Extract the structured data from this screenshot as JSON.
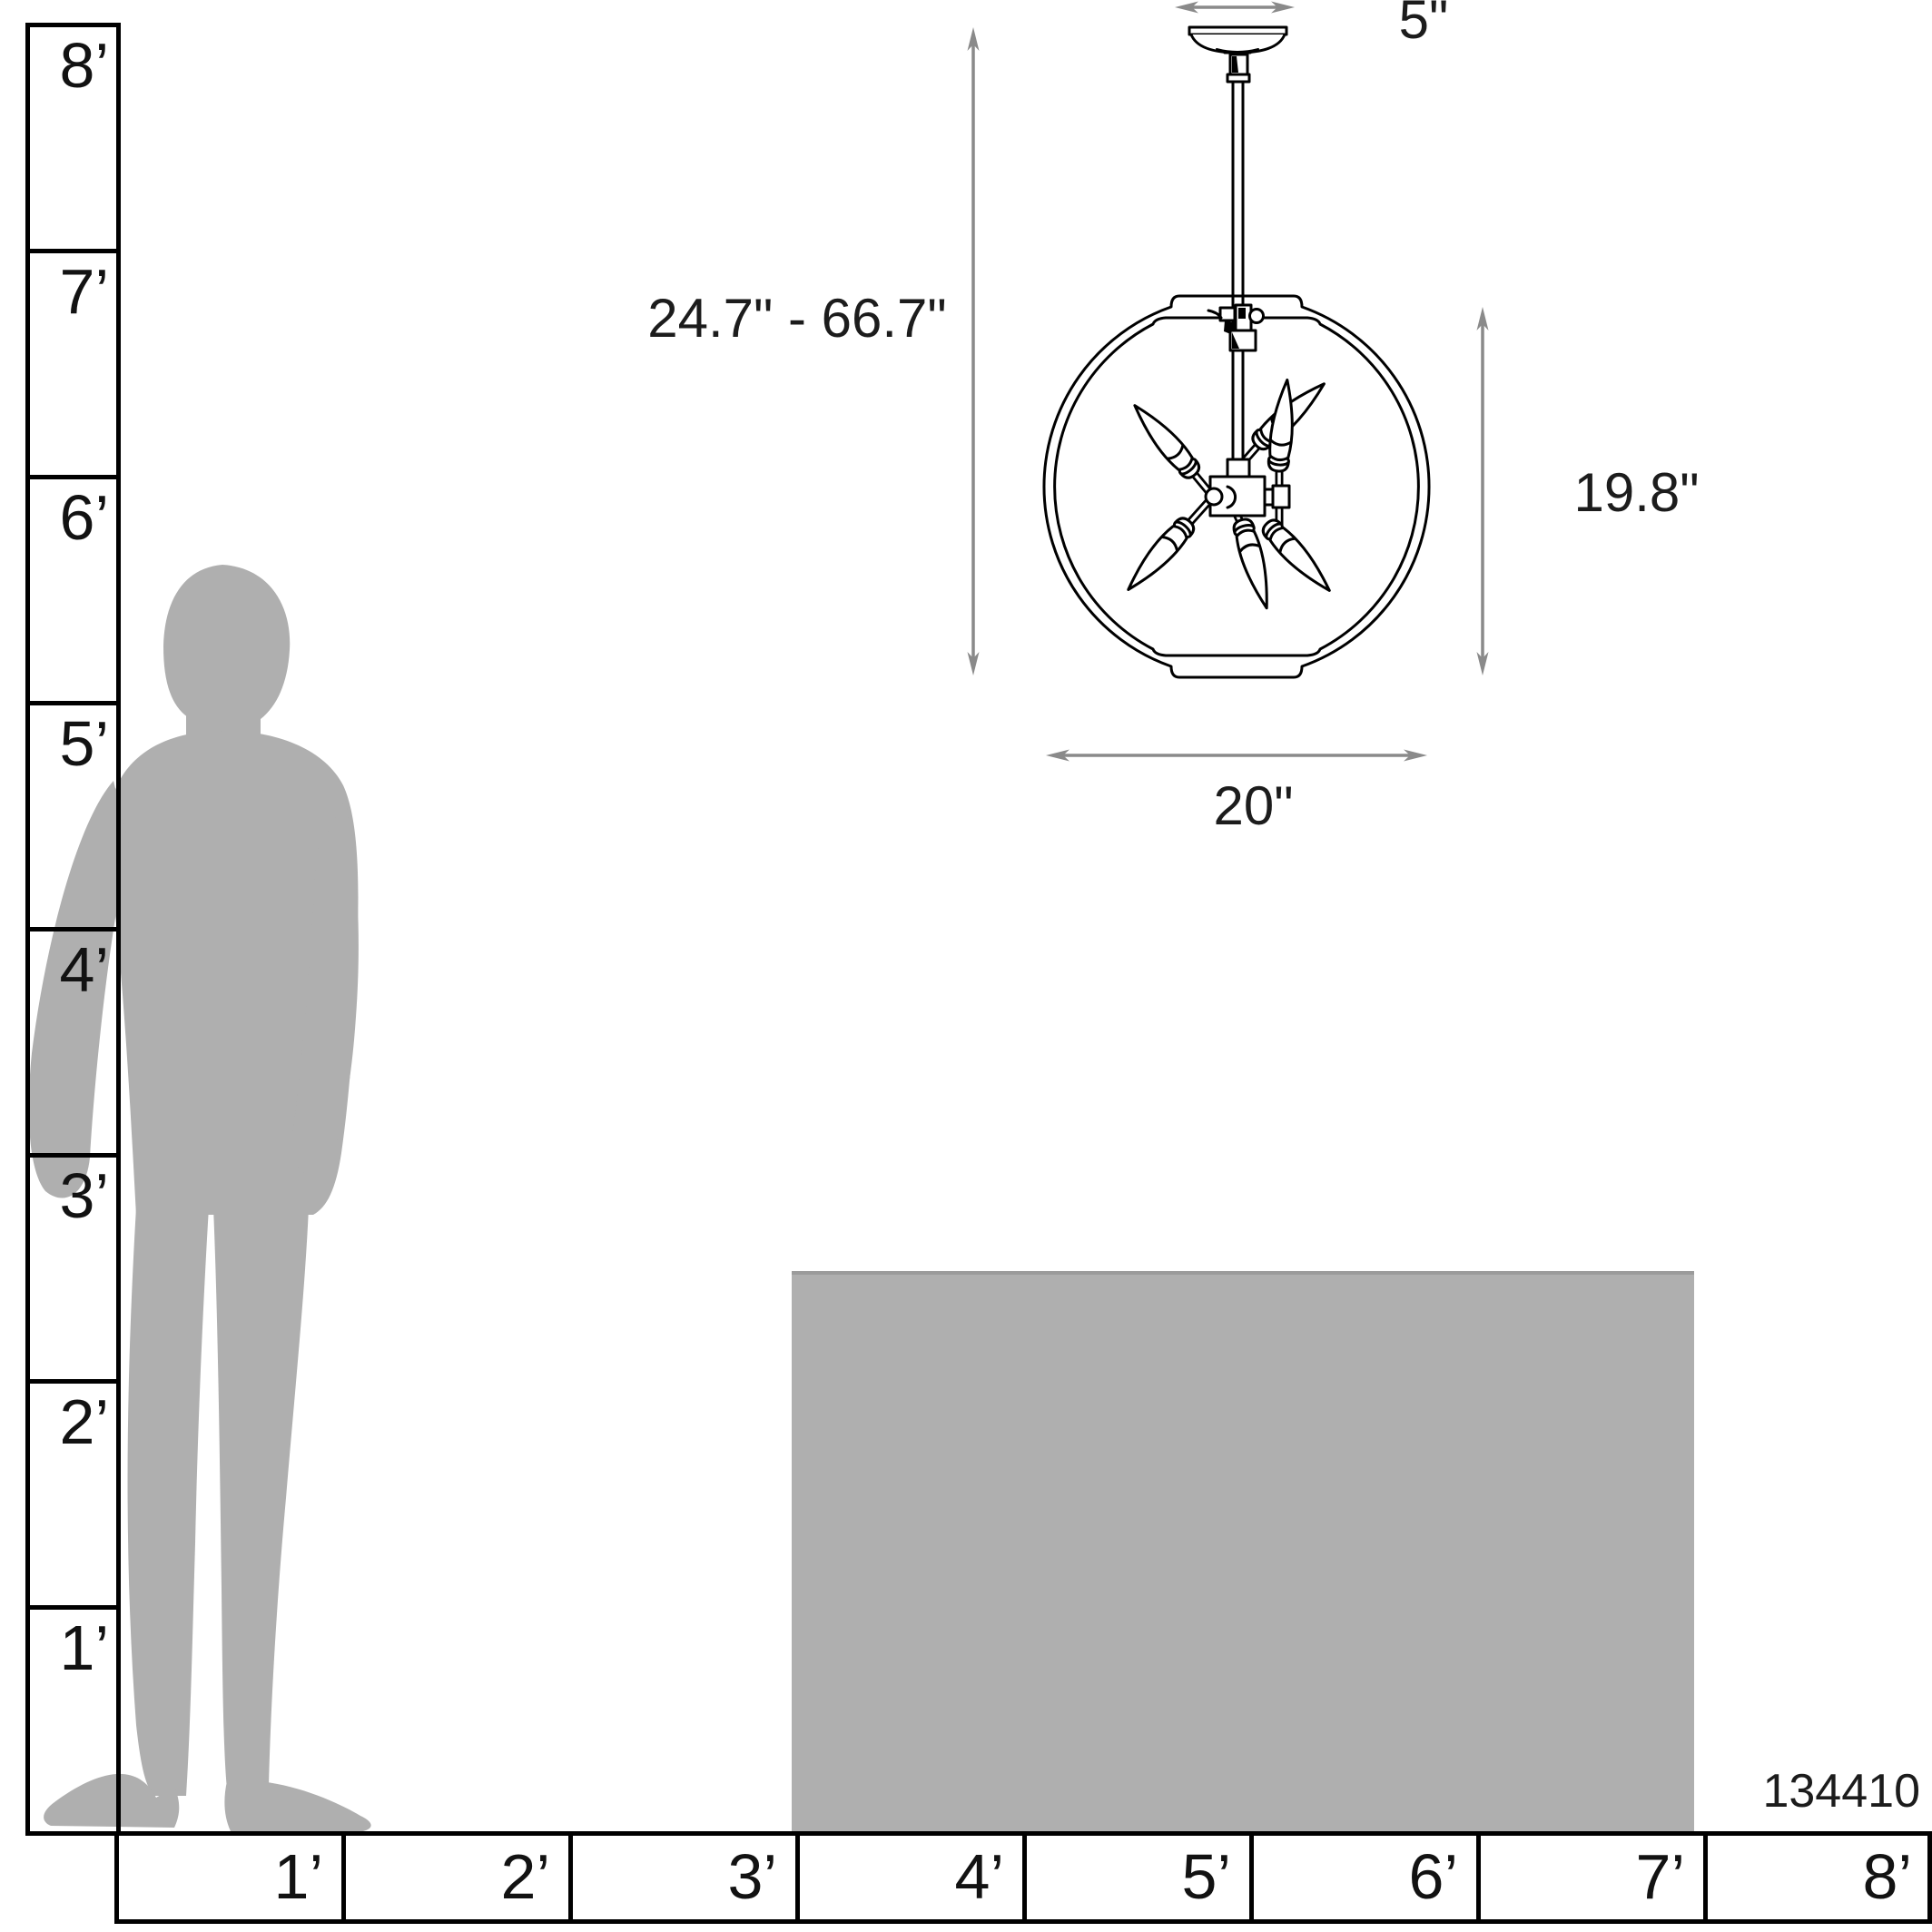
{
  "diagram": {
    "title": "chandelier-scale-dimension-diagram",
    "product_code": "134410",
    "dimensions": {
      "canopy_width": "5\"",
      "height_range": "24.7\" - 66.7\"",
      "fixture_height": "19.8\"",
      "fixture_width": "20\""
    },
    "vertical_ruler": {
      "labels": [
        "8’",
        "7’",
        "6’",
        "5’",
        "4’",
        "3’",
        "2’",
        "1’"
      ]
    },
    "horizontal_ruler": {
      "labels": [
        "1’",
        "2’",
        "3’",
        "4’",
        "5’",
        "6’",
        "7’",
        "8’"
      ]
    },
    "colors": {
      "silhouette_gray": "#AFAFAF",
      "table_gray": "#AFAFAF",
      "dimension_gray": "#8A8A8A",
      "line_black": "#000000"
    }
  }
}
